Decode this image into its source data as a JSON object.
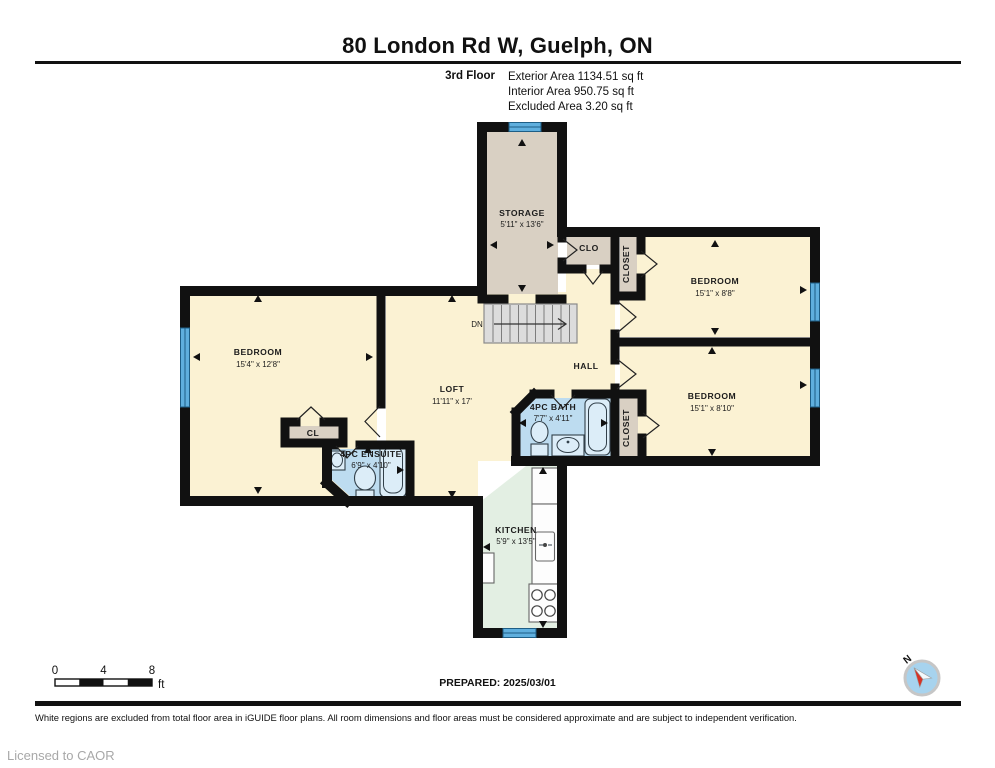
{
  "header": {
    "title": "80 London Rd W, Guelph, ON",
    "floor_label": "3rd Floor",
    "area_line_1": "Exterior Area 1134.51 sq ft",
    "area_line_2": "Interior Area 950.75 sq ft",
    "area_line_3": "Excluded Area 3.20 sq ft"
  },
  "rooms": {
    "storage": {
      "name": "STORAGE",
      "dims": "5'11\" x 13'6\""
    },
    "clo": {
      "name": "CLO"
    },
    "closet_top": {
      "name": "CLOSET"
    },
    "bedroom_ne": {
      "name": "BEDROOM",
      "dims": "15'1\" x 8'8\""
    },
    "bedroom_se": {
      "name": "BEDROOM",
      "dims": "15'1\" x 8'10\""
    },
    "bedroom_w": {
      "name": "BEDROOM",
      "dims": "15'4\" x 12'8\""
    },
    "loft": {
      "name": "LOFT",
      "dims": "11'11\" x 17'"
    },
    "hall": {
      "name": "HALL"
    },
    "bath": {
      "name": "4PC BATH",
      "dims": "7'7\" x 4'11\""
    },
    "closet_bottom": {
      "name": "CLOSET"
    },
    "cl": {
      "name": "CL"
    },
    "ensuite": {
      "name": "4PC ENSUITE",
      "dims": "6'9\" x 4'10\""
    },
    "kitchen": {
      "name": "KITCHEN",
      "dims": "5'9\" x 13'5\""
    },
    "stairs": {
      "label": "DN"
    }
  },
  "scale_bar": {
    "tick_0": "0",
    "tick_4": "4",
    "tick_8": "8",
    "unit": "ft"
  },
  "compass": {
    "north_label": "N"
  },
  "footer": {
    "prepared": "PREPARED: 2025/03/01",
    "disclaimer": "White regions are excluded from total floor area in iGUIDE floor plans. All room dimensions and floor areas must be considered approximate and are subject to independent verification.",
    "license": "Licensed to CAOR"
  },
  "palette": {
    "wall": "#111111",
    "room_cream": "#FBF2D3",
    "closet_beige": "#D9D0C3",
    "bath_blue": "#BDDCF0",
    "kitchen_green": "#E3EFE3",
    "window_blue": "#5FAFDE",
    "stair_gray": "#DCDCDC",
    "compass_blue": "#A7D3EE",
    "compass_red": "#D63226"
  }
}
